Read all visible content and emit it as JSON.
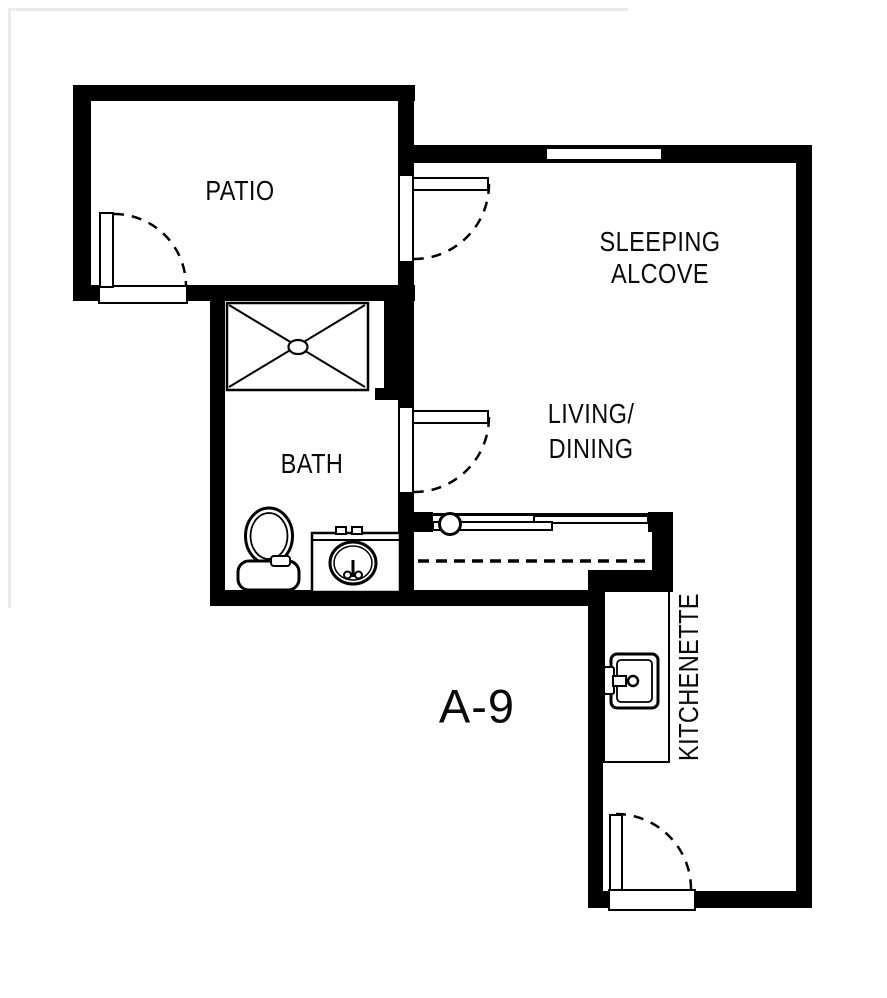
{
  "floor_plan": {
    "unit_label": "A-9",
    "rooms": {
      "patio": {
        "label": "PATIO"
      },
      "sleeping_alcove": {
        "label_line1": "SLEEPING",
        "label_line2": "ALCOVE"
      },
      "living_dining": {
        "label_line1": "LIVING/",
        "label_line2": "DINING"
      },
      "bath": {
        "label": "BATH"
      },
      "kitchenette": {
        "label": "KITCHENETTE"
      }
    },
    "fixtures": [
      "shower",
      "toilet",
      "vanity-sink",
      "kitchen-sink",
      "sliding-closet-doors"
    ],
    "colors": {
      "wall": "#000000",
      "background": "#ffffff",
      "line": "#000000"
    }
  }
}
